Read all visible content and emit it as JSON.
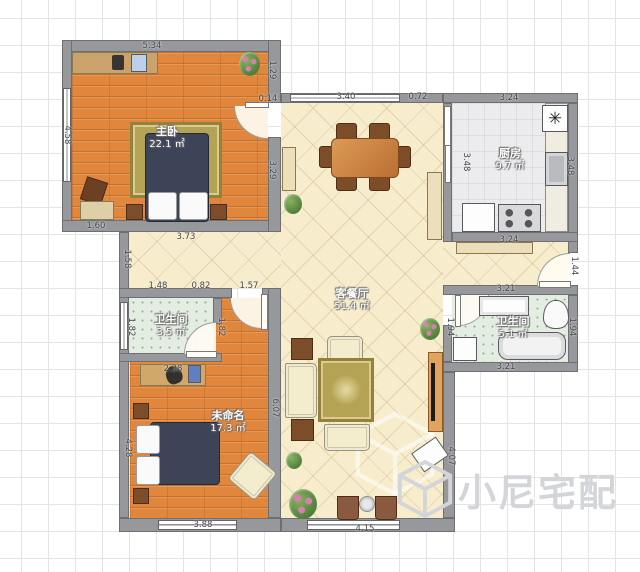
{
  "plan_title": "apartment-floor-plan",
  "watermark": {
    "brand": "小尼宅配"
  },
  "rooms": [
    {
      "id": "master-bedroom",
      "name": "主卧",
      "area": "22.1 ㎡"
    },
    {
      "id": "kitchen",
      "name": "厨房",
      "area": "9.7 ㎡"
    },
    {
      "id": "living-dining",
      "name": "客餐厅",
      "area": "51.4 ㎡"
    },
    {
      "id": "bathroom-small",
      "name": "卫生间",
      "area": "3.5 ㎡"
    },
    {
      "id": "bathroom-large",
      "name": "卫生间",
      "area": "5.1 ㎡"
    },
    {
      "id": "second-bedroom",
      "name": "未命名",
      "area": "17.3 ㎡"
    }
  ],
  "icons": {
    "fridge_glyph": "✳"
  },
  "colors": {
    "wall": "#97989c",
    "wood_floor": "#e1873d",
    "living_floor": "#f7edcd",
    "kitchen_floor": "#ececee",
    "bath_floor": "#e4ede1",
    "bed": "#3e4458",
    "rug": "#b5a355",
    "watermark": "#d3d5d9"
  },
  "dimensions": [
    {
      "text": "5.34",
      "x": 152,
      "y": 46,
      "vertical": false
    },
    {
      "text": "4.58",
      "x": 67,
      "y": 135,
      "vertical": true
    },
    {
      "text": "1.29",
      "x": 272,
      "y": 70,
      "vertical": true
    },
    {
      "text": "0.14",
      "x": 268,
      "y": 99,
      "vertical": false
    },
    {
      "text": "3.29",
      "x": 272,
      "y": 170,
      "vertical": true
    },
    {
      "text": "1.60",
      "x": 96,
      "y": 226,
      "vertical": false
    },
    {
      "text": "3.73",
      "x": 186,
      "y": 237,
      "vertical": false
    },
    {
      "text": "3.40",
      "x": 346,
      "y": 97,
      "vertical": false
    },
    {
      "text": "0.72",
      "x": 418,
      "y": 97,
      "vertical": false
    },
    {
      "text": "3.24",
      "x": 509,
      "y": 98,
      "vertical": false
    },
    {
      "text": "3.48",
      "x": 466,
      "y": 162,
      "vertical": true
    },
    {
      "text": "3.48",
      "x": 570,
      "y": 166,
      "vertical": true
    },
    {
      "text": "3.24",
      "x": 509,
      "y": 240,
      "vertical": false
    },
    {
      "text": "1.44",
      "x": 574,
      "y": 266,
      "vertical": true
    },
    {
      "text": "3.21",
      "x": 506,
      "y": 289,
      "vertical": false
    },
    {
      "text": "1.94",
      "x": 450,
      "y": 327,
      "vertical": true
    },
    {
      "text": "1.94",
      "x": 572,
      "y": 327,
      "vertical": true
    },
    {
      "text": "3.21",
      "x": 506,
      "y": 367,
      "vertical": false
    },
    {
      "text": "1.58",
      "x": 127,
      "y": 259,
      "vertical": true
    },
    {
      "text": "1.48",
      "x": 158,
      "y": 286,
      "vertical": false
    },
    {
      "text": "0.82",
      "x": 201,
      "y": 286,
      "vertical": false
    },
    {
      "text": "1.57",
      "x": 249,
      "y": 286,
      "vertical": false
    },
    {
      "text": "1.82",
      "x": 131,
      "y": 327,
      "vertical": true
    },
    {
      "text": "1.82",
      "x": 221,
      "y": 327,
      "vertical": true
    },
    {
      "text": "2.38",
      "x": 173,
      "y": 369,
      "vertical": false
    },
    {
      "text": "4.28",
      "x": 128,
      "y": 448,
      "vertical": true
    },
    {
      "text": "6.07",
      "x": 275,
      "y": 408,
      "vertical": true
    },
    {
      "text": "3.88",
      "x": 203,
      "y": 525,
      "vertical": false
    },
    {
      "text": "4.15",
      "x": 365,
      "y": 529,
      "vertical": false
    },
    {
      "text": "4.07",
      "x": 451,
      "y": 456,
      "vertical": true
    }
  ]
}
